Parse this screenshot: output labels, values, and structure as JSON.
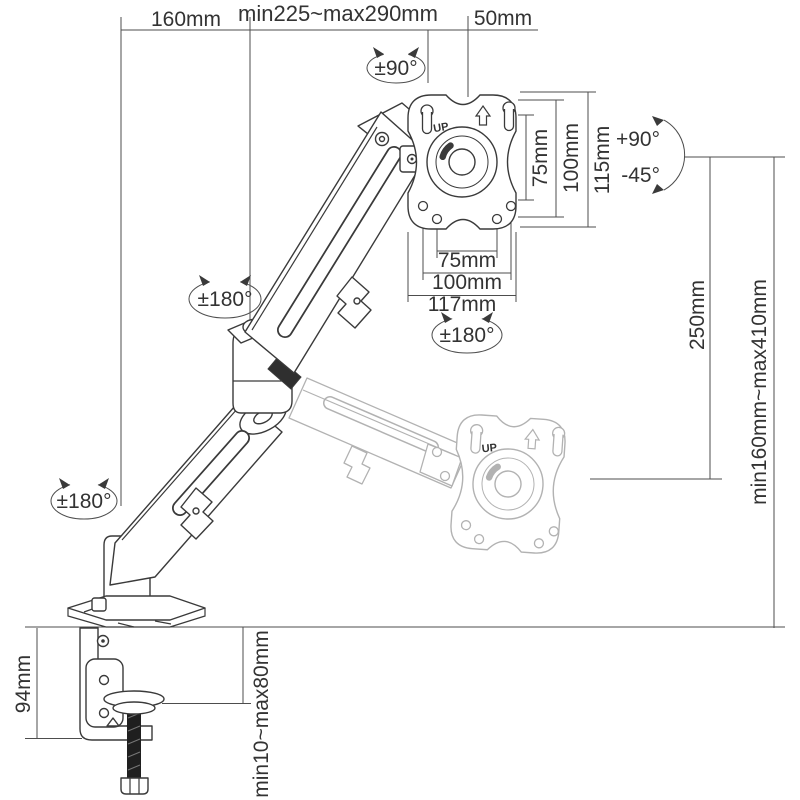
{
  "title": "desk mount monitor arm dimension diagram",
  "colors": {
    "background": "#ffffff",
    "line": "#3a3a3a",
    "dimension_line": "#4d4d4d",
    "ghost_arm": "#b2b2b2",
    "text": "#333333",
    "screw_shaft": "#1f1f1f"
  },
  "dimensions": {
    "top": {
      "rear_arm": "160mm",
      "front_arm_range": "min225~max290mm",
      "head_offset": "50mm"
    },
    "vesa_vertical": [
      "75mm",
      "100mm",
      "115mm"
    ],
    "vesa_horizontal": [
      "75mm",
      "100mm",
      "117mm"
    ],
    "height_travel": "250mm",
    "height_range": "min160mm~max410mm",
    "clamp_height": "94mm",
    "desk_thickness_range": "min10~max80mm"
  },
  "rotations": {
    "vesa_plate_rotation": "±90°",
    "upper_arm_swivel": "±180°",
    "vesa_swivel": "±180°",
    "base_swivel": "±180°",
    "tilt_up": "+90°",
    "tilt_down": "-45°"
  },
  "markings": {
    "vesa_up": "UP"
  }
}
